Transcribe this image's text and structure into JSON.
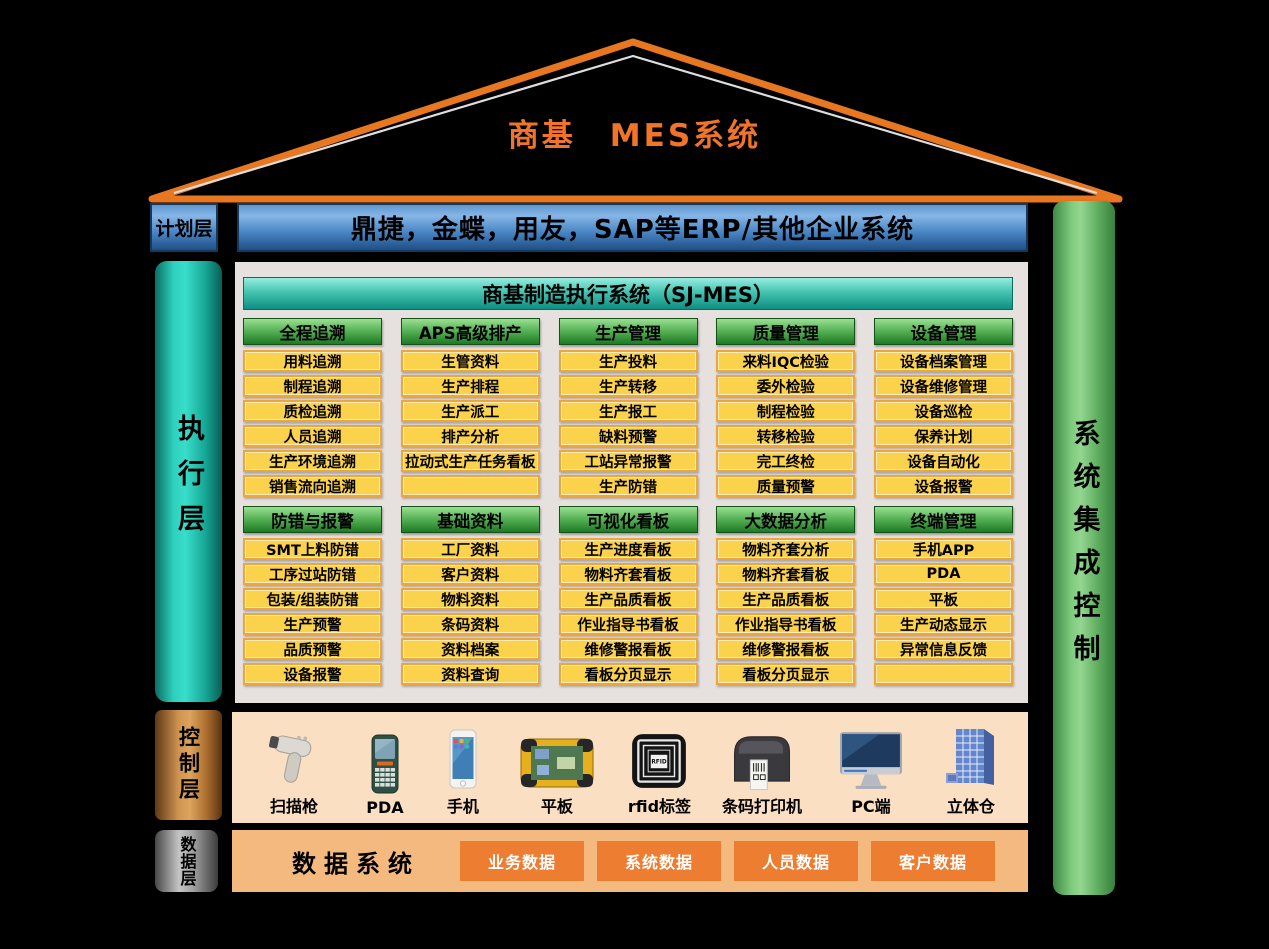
{
  "title": "商基　MES系统",
  "layers": {
    "plan": {
      "label": "计划层",
      "banner": "鼎捷，金蝶，用友，SAP等ERP/其他企业系统"
    },
    "exec": {
      "label": "执行层"
    },
    "control": {
      "label": "控制层"
    },
    "data": {
      "label": "数据层"
    }
  },
  "right_bar": {
    "label": "系统集成控制"
  },
  "mes": {
    "header": "商基制造执行系统（SJ-MES）",
    "rows": [
      {
        "columns": [
          {
            "header": "全程追溯",
            "items": [
              "用料追溯",
              "制程追溯",
              "质检追溯",
              "人员追溯",
              "生产环境追溯",
              "销售流向追溯"
            ]
          },
          {
            "header": "APS高级排产",
            "items": [
              "生管资料",
              "生产排程",
              "生产派工",
              "排产分析",
              "拉动式生产任务看板",
              ""
            ]
          },
          {
            "header": "生产管理",
            "items": [
              "生产投料",
              "生产转移",
              "生产报工",
              "缺料预警",
              "工站异常报警",
              "生产防错"
            ]
          },
          {
            "header": "质量管理",
            "items": [
              "来料IQC检验",
              "委外检验",
              "制程检验",
              "转移检验",
              "完工终检",
              "质量预警"
            ]
          },
          {
            "header": "设备管理",
            "items": [
              "设备档案管理",
              "设备维修管理",
              "设备巡检",
              "保养计划",
              "设备自动化",
              "设备报警"
            ]
          }
        ]
      },
      {
        "columns": [
          {
            "header": "防错与报警",
            "items": [
              "SMT上料防错",
              "工序过站防错",
              "包装/组装防错",
              "生产预警",
              "品质预警",
              "设备报警"
            ]
          },
          {
            "header": "基础资料",
            "items": [
              "工厂资料",
              "客户资料",
              "物料资料",
              "条码资料",
              "资料档案",
              "资料查询"
            ]
          },
          {
            "header": "可视化看板",
            "items": [
              "生产进度看板",
              "物料齐套看板",
              "生产品质看板",
              "作业指导书看板",
              "维修警报看板",
              "看板分页显示"
            ]
          },
          {
            "header": "大数据分析",
            "items": [
              "物料齐套分析",
              "物料齐套看板",
              "生产品质看板",
              "作业指导书看板",
              "维修警报看板",
              "看板分页显示"
            ]
          },
          {
            "header": "终端管理",
            "items": [
              "手机APP",
              "PDA",
              "平板",
              "生产动态显示",
              "异常信息反馈",
              ""
            ]
          }
        ]
      }
    ]
  },
  "devices": [
    {
      "name": "扫描枪",
      "icon": "barcode-scanner"
    },
    {
      "name": "PDA",
      "icon": "pda"
    },
    {
      "name": "手机",
      "icon": "phone"
    },
    {
      "name": "平板",
      "icon": "tablet"
    },
    {
      "name": "rfid标签",
      "icon": "rfid-tag"
    },
    {
      "name": "条码打印机",
      "icon": "barcode-printer"
    },
    {
      "name": "PC端",
      "icon": "desktop"
    },
    {
      "name": "立体仓",
      "icon": "warehouse"
    }
  ],
  "data_layer": {
    "title": "数据系统",
    "items": [
      "业务数据",
      "系统数据",
      "人员数据",
      "客户数据"
    ]
  },
  "colors": {
    "roof_orange": "#E87722",
    "title_orange": "#F0752B",
    "panel_bg": "#E6E1DF",
    "item_yellow": "#FBD24B",
    "item_border": "#EFA53C",
    "control_bg": "#FBDFC3",
    "data_bg": "#F4B97E",
    "data_box_orange": "#ED7D31"
  }
}
